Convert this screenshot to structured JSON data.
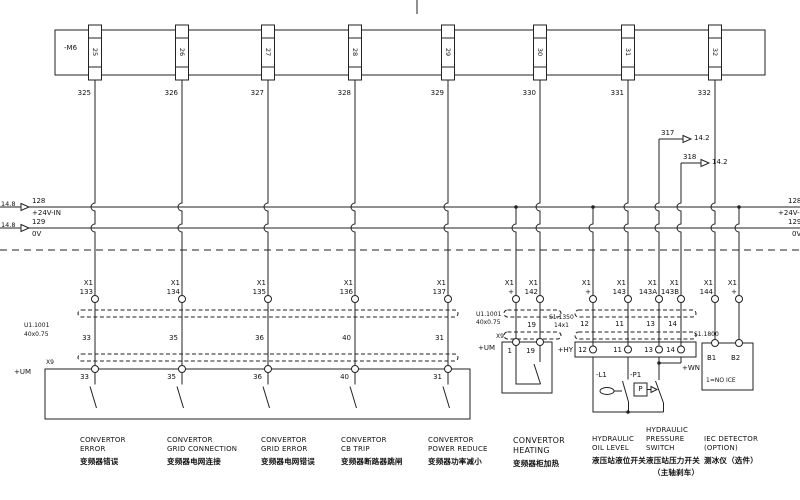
{
  "strip": {
    "name": "-M6",
    "terminals": [
      "25",
      "26",
      "27",
      "28",
      "29",
      "30",
      "31",
      "32"
    ],
    "wire_numbers": [
      "325",
      "326",
      "327",
      "328",
      "329",
      "330",
      "331",
      "332"
    ]
  },
  "buses": {
    "v24": {
      "ref": "14.8",
      "number": "128",
      "label": "+24V-IN"
    },
    "v0": {
      "ref": "14.8",
      "number": "129",
      "label": "0V"
    }
  },
  "crossrefs": [
    {
      "wire": "317",
      "dest": "14.2"
    },
    {
      "wire": "318",
      "dest": "14.2"
    }
  ],
  "x1": {
    "name": "X1",
    "terms": [
      "133",
      "134",
      "135",
      "136",
      "137",
      "+",
      "142",
      "+",
      "143",
      "143A",
      "143B",
      "144",
      "+"
    ]
  },
  "cable_left": {
    "name": "U1.1001",
    "size": "40x0.75",
    "wires": [
      "33",
      "35",
      "36",
      "40",
      "31"
    ]
  },
  "box_left": {
    "connector": "X9",
    "location": "+UM",
    "terms": [
      "33",
      "35",
      "36",
      "40",
      "31"
    ]
  },
  "cable_heat": {
    "name": "U1.1001",
    "size": "40x0.75",
    "wire": "19"
  },
  "box_heat": {
    "connector": "X9",
    "location": "+UM",
    "terms": [
      "1",
      "19"
    ]
  },
  "cable_hyd": {
    "name": "S1.1350",
    "size": "14x1",
    "wires": [
      "12",
      "11",
      "13",
      "14"
    ]
  },
  "box_hyd": {
    "location": "+HY",
    "terms": [
      "12",
      "11",
      "13",
      "14"
    ]
  },
  "devices": {
    "level": "-L1",
    "pressure": "-P1",
    "pressure_symbol": "P"
  },
  "iec": {
    "tag": "S1.1800",
    "location": "+WN",
    "terms": [
      "B1",
      "B2"
    ],
    "note": "1=NO ICE"
  },
  "captions": [
    {
      "l1": "CONVERTOR",
      "l2": "ERROR",
      "zh": "变频器错误"
    },
    {
      "l1": "CONVERTOR",
      "l2": "GRID CONNECTION",
      "zh": "变频器电网连接"
    },
    {
      "l1": "CONVERTOR",
      "l2": "GRID ERROR",
      "zh": "变频器电网错误"
    },
    {
      "l1": "CONVERTOR",
      "l2": "CB TRIP",
      "zh": "变频器断路器跳闸"
    },
    {
      "l1": "CONVERTOR",
      "l2": "POWER REDUCE",
      "zh": "变频器功率减小"
    },
    {
      "l1": "CONVERTOR",
      "l2": "HEATING",
      "zh": "变频器柜加热"
    },
    {
      "l1": "HYDRAULIC",
      "l2": "OIL LEVEL",
      "zh": "液压站液位开关"
    },
    {
      "l1": "HYDRAULIC",
      "l2": "PRESSURE",
      "l3": "SWITCH",
      "zh": "液压站压力开关",
      "zh2": "（主轴刹车）"
    },
    {
      "l1": "IEC DETECTOR",
      "l2": "(OPTION)",
      "zh": "测冰仪（选件）"
    }
  ]
}
